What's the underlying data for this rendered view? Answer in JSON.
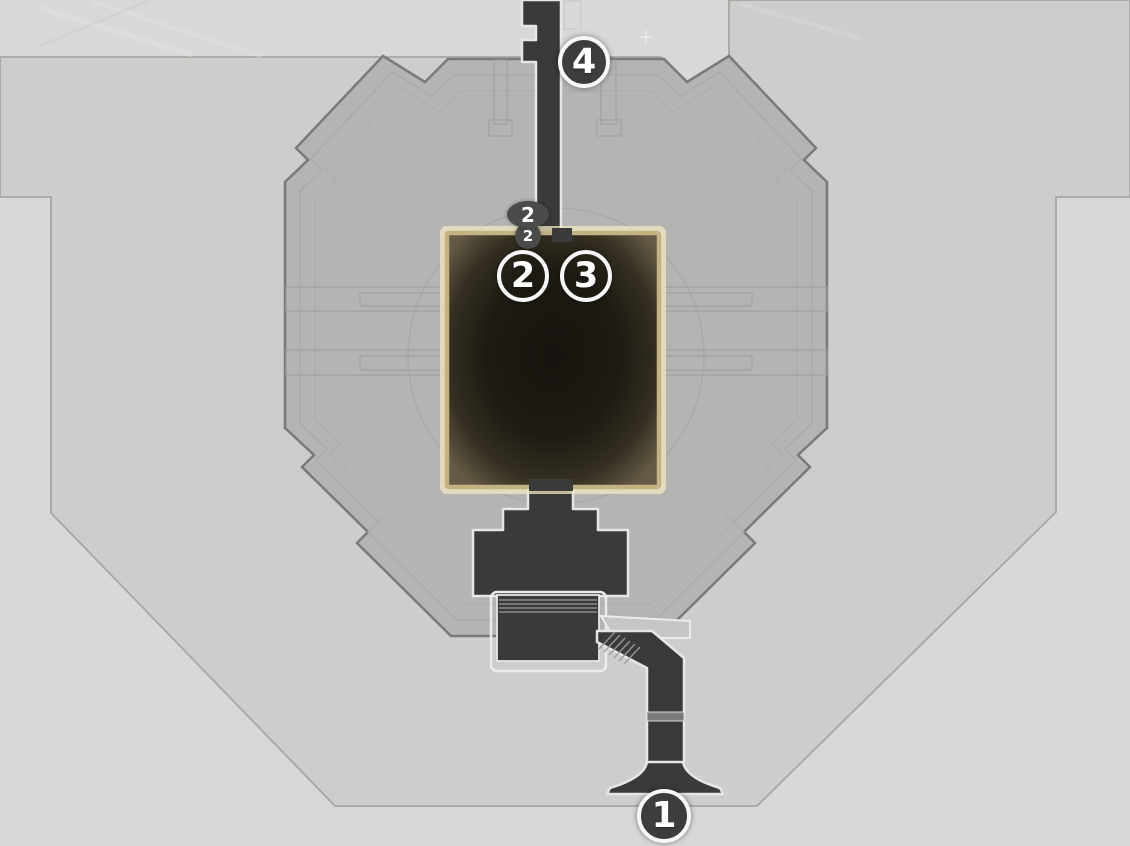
{
  "map": {
    "title": "station-level-map",
    "markers": [
      {
        "id": "1",
        "label": "1",
        "kind": "numbered-waypoint",
        "x": 664,
        "y": 816
      },
      {
        "id": "2",
        "label": "2",
        "kind": "numbered-waypoint",
        "x": 523,
        "y": 276
      },
      {
        "id": "3",
        "label": "3",
        "kind": "numbered-waypoint",
        "x": 586,
        "y": 276
      },
      {
        "id": "4",
        "label": "4",
        "kind": "numbered-waypoint",
        "x": 584,
        "y": 62
      },
      {
        "id": "2-upper",
        "label": "2",
        "kind": "floor-level-badge",
        "x": 528,
        "y": 214
      },
      {
        "id": "2-lower",
        "label": "2",
        "kind": "floor-level-badge",
        "x": 528,
        "y": 236
      }
    ],
    "colors": {
      "background": "#d8d8d7",
      "floor": "#cdcdcb",
      "building": "#b4b4b2",
      "building_outline": "#7a7a78",
      "corridor_fill": "#3a3a38",
      "corridor_outline": "#e6e6e4",
      "room_border": "#c3b383",
      "room_glow": "#f3e8c2",
      "marker_fill": "#3d3d3b",
      "marker_ring": "#ffffff",
      "badge_fill": "#4b4b49"
    }
  }
}
